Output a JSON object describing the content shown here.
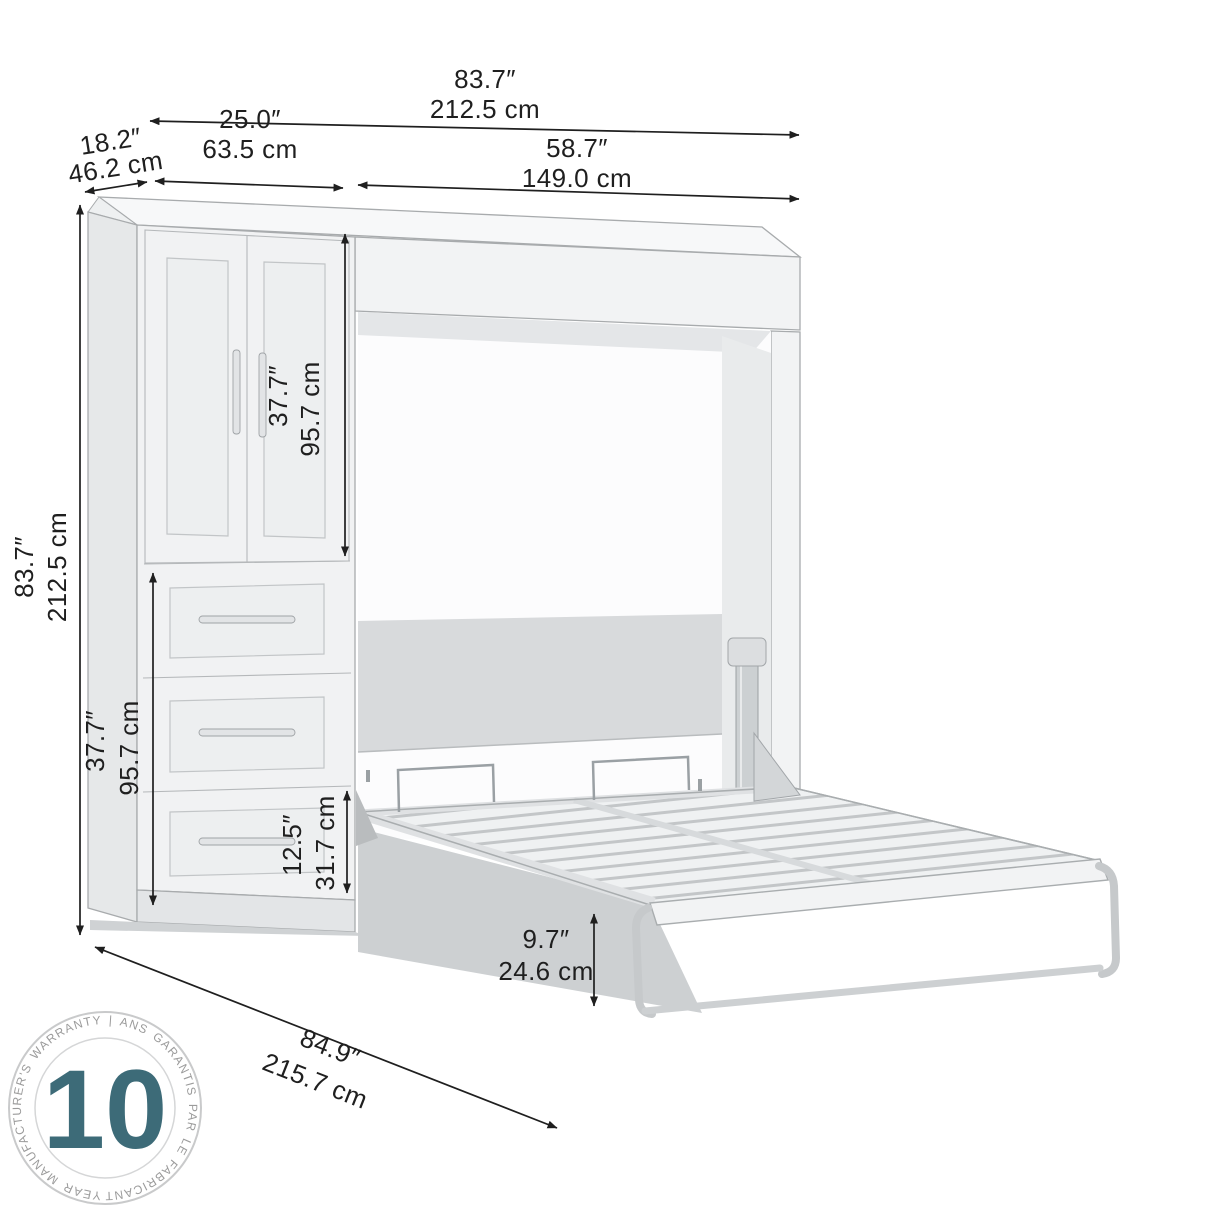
{
  "dimensions": {
    "overall_width": {
      "inches": "83.7″",
      "cm": "212.5 cm"
    },
    "bed_opening_width": {
      "inches": "58.7″",
      "cm": "149.0 cm"
    },
    "cabinet_width": {
      "inches": "25.0″",
      "cm": "63.5 cm"
    },
    "side_depth": {
      "inches": "18.2″",
      "cm": "46.2 cm"
    },
    "overall_height": {
      "inches": "83.7″",
      "cm": "212.5 cm"
    },
    "door_height": {
      "inches": "37.7″",
      "cm": "95.7 cm"
    },
    "drawer_section_height": {
      "inches": "37.7″",
      "cm": "95.7 cm"
    },
    "bottom_drawer_height": {
      "inches": "12.5″",
      "cm": "31.7 cm"
    },
    "bed_frame_height": {
      "inches": "9.7″",
      "cm": "24.6 cm"
    },
    "open_depth_diagonal": {
      "inches": "84.9″",
      "cm": "215.7 cm"
    }
  },
  "badge": {
    "years": "10",
    "ring_text": "YEAR MANUFACTURER'S WARRANTY | ANS GARANTIS PAR LE FABRICANT |",
    "accent_color": "#3d6b78",
    "ring_text_color": "#9b9b9b",
    "ring_border_color": "#c9cacb"
  },
  "colors": {
    "background": "#ffffff",
    "dimension_lines": "#1f1f1f",
    "furniture_outline": "#a8abad",
    "furniture_face": "#f1f2f3",
    "furniture_side": "#e6e8e9",
    "headboard_panel": "#d8dadc",
    "bed_underside": "#cdd0d2"
  }
}
